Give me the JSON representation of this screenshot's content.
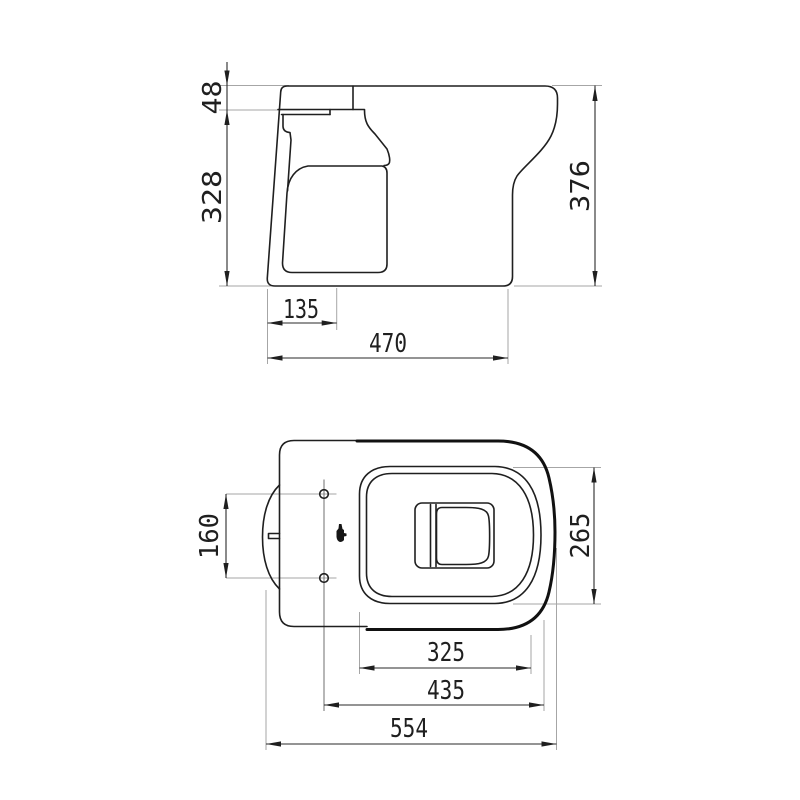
{
  "colors": {
    "line": "#1f1f1f",
    "dimension_line": "#2a2a2a",
    "extension_line": "#a6a6a6",
    "background": "#ffffff"
  },
  "side_view": {
    "dims": {
      "rim_lip_height": "48",
      "rim_to_floor_height": "328",
      "total_height": "376",
      "outlet_offset": "135",
      "total_depth": "470"
    }
  },
  "top_view": {
    "dims": {
      "fixing_hole_spacing": "160",
      "seat_depth": "265",
      "seat_plateau_width": "325",
      "hole_to_front_length": "435",
      "total_length": "554"
    }
  }
}
